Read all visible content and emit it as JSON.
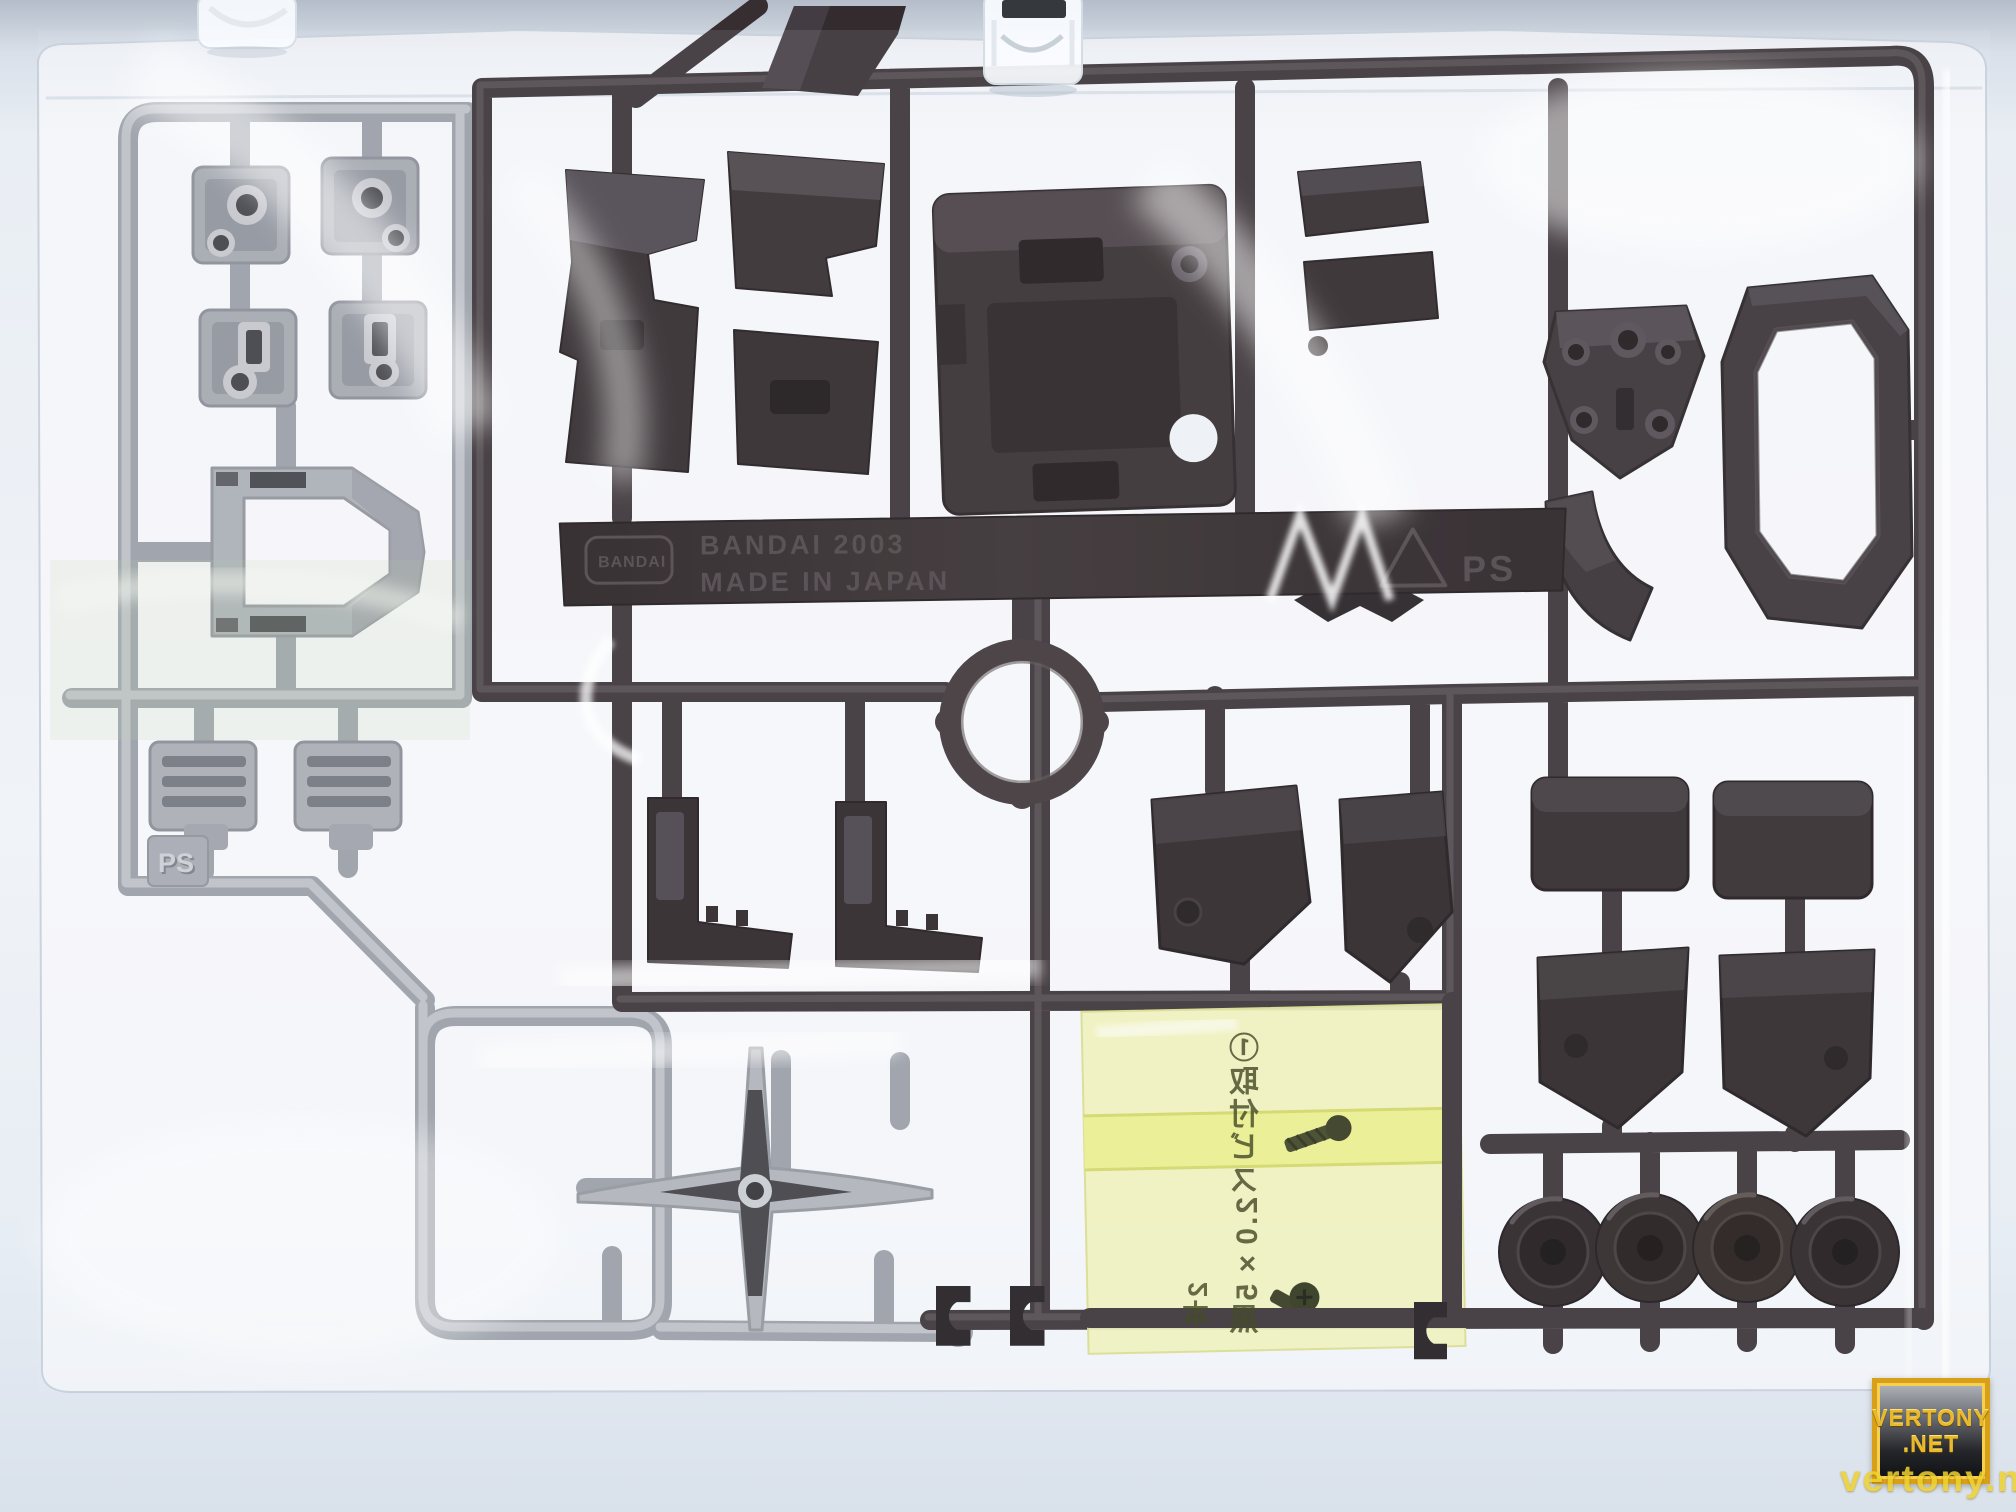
{
  "runner_tag": {
    "logo_text": "BANDAI",
    "line1": "BANDAI 2003",
    "line2": "MADE IN JAPAN",
    "material": "PS"
  },
  "gray_runner": {
    "material": "PS"
  },
  "screw_bag": {
    "label": "①取付ビス2.0×5黒",
    "quantity": "2本"
  },
  "watermark": {
    "badge_line1": "VERTONY",
    "badge_line2": ".NET",
    "overlay": "vertony.net"
  },
  "colors": {
    "background": "#edf1f6",
    "background_top_band": "#b4bdc9",
    "bag_film": "#fbfcfe",
    "gray_plastic": "#aeb2b9",
    "dark_plastic": "#2b2427",
    "screw_bag_yellow": "#eff1b8",
    "screw_bag_band": "#e9ee8a",
    "watermark_gold": "#e9b92b",
    "watermark_url_yellow": "#f0d22e"
  }
}
